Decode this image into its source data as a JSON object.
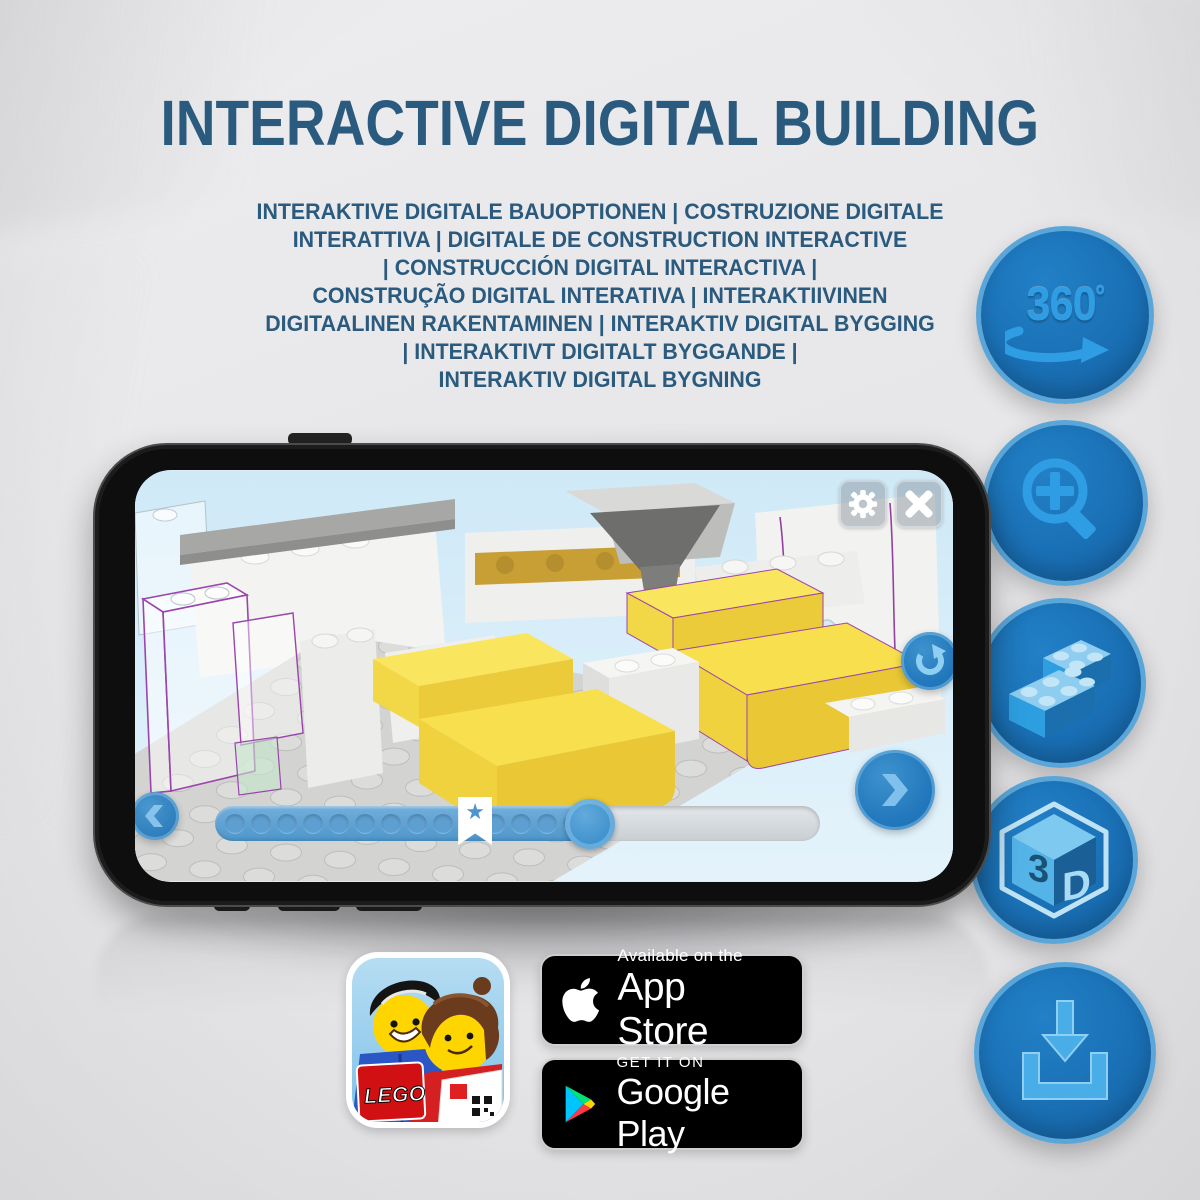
{
  "header": {
    "title": "INTERACTIVE DIGITAL BUILDING",
    "subtitle": "INTERAKTIVE DIGITALE BAUOPTIONEN | COSTRUZIONE DIGITALE\nINTERATTIVA | DIGITALE DE CONSTRUCTION INTERACTIVE\n| CONSTRUCCIÓN DIGITAL INTERACTIVA |\nCONSTRUÇÃO DIGITAL INTERATIVA | INTERAKTIIVINEN\nDIGITAALINEN RAKENTAMINEN | INTERAKTIV DIGITAL BYGGING\n| INTERAKTIVT DIGITALT BYGGANDE |\nINTERAKTIV DIGITAL BYGNING"
  },
  "feature_badges": {
    "rotate_360": {
      "label": "360",
      "degree_symbol": "º",
      "icon": "360-rotation-arrow"
    },
    "zoom": {
      "icon": "magnifier-plus"
    },
    "bricks": {
      "icon": "two-lego-bricks"
    },
    "view_3d": {
      "label_left": "3",
      "label_right": "D",
      "icon": "3d-cube"
    },
    "download": {
      "icon": "download-arrow-tray"
    }
  },
  "phone_ui": {
    "progress_percent": 62,
    "bookmark_percent": 43,
    "bookmark_glyph": "★",
    "dot_count": 18
  },
  "store_badges": {
    "app_store": {
      "tagline": "Available on the",
      "store_name": "App Store"
    },
    "google_play": {
      "tagline": "GET IT ON",
      "store_name": "Google Play"
    }
  },
  "app_icon": {
    "logo_text": "LEGO"
  },
  "colors": {
    "title_blue": "#2a5a7e",
    "circle_blue": "#1a70b5",
    "circle_rim": "#5ba6d9",
    "icon_blue": "#2f9de4",
    "ui_blue": "#2379bd",
    "brick_yellow": "#f6dd4c",
    "outline_purple": "#9b44ad",
    "play_cyan": "#00c4ff",
    "play_green": "#00e376",
    "play_yellow": "#ffd400",
    "play_red": "#ff3a44",
    "lego_red": "#d01012"
  }
}
